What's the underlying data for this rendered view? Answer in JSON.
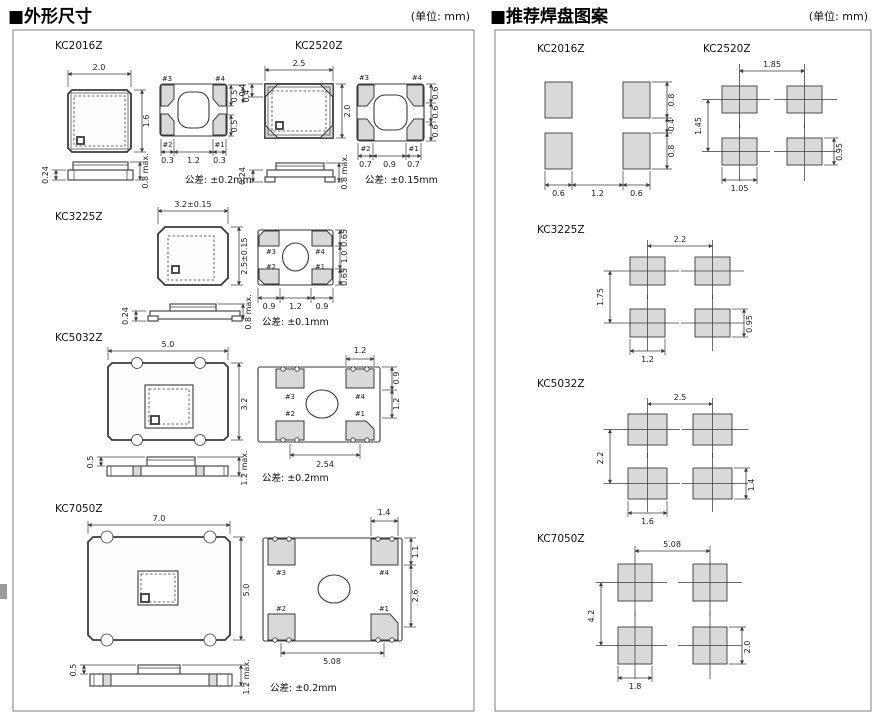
{
  "header": {
    "outline_title": "■外形尺寸",
    "land_title": "■推荐焊盘图案",
    "unit": "(单位: mm)"
  },
  "pad_labels": {
    "p1": "#1",
    "p2": "#2",
    "p3": "#3",
    "p4": "#4"
  },
  "outline": {
    "k2016": {
      "name": "KC2016Z",
      "top_w": "2.0",
      "top_h": "1.6",
      "right_dims": [
        "0.5",
        "0.4",
        "0.5"
      ],
      "bottom_dims": [
        "0.3",
        "1.2",
        "0.3"
      ],
      "side_thickness": "0.24",
      "side_height": "0.8 max.",
      "tolerance": "公差: ±0.2mm"
    },
    "k2520": {
      "name": "KC2520Z",
      "top_w": "2.5",
      "top_h": "2.0",
      "corner_pad": "0.4",
      "right_dims": [
        "0.6",
        "0.6",
        "0.6"
      ],
      "bottom_dims": [
        "0.7",
        "0.9",
        "0.7"
      ],
      "side_thickness": "0.24",
      "side_height": "0.8 max.",
      "tolerance": "公差: ±0.15mm"
    },
    "k3225": {
      "name": "KC3225Z",
      "top_w": "3.2±0.15",
      "top_h": "2.5±0.15",
      "right_dims": [
        "0.65",
        "1.0",
        "0.65"
      ],
      "bottom_dims": [
        "0.9",
        "1.2",
        "0.9"
      ],
      "side_thickness": "0.24",
      "side_height": "0.8 max.",
      "tolerance": "公差: ±0.1mm"
    },
    "k5032": {
      "name": "KC5032Z",
      "top_w": "5.0",
      "top_h": "3.2",
      "pad_w": "1.2",
      "right_dims": [
        "0.9",
        "1.2"
      ],
      "bottom_dim": "2.54",
      "side_thickness": "0.5",
      "side_height": "1.2 max.",
      "tolerance": "公差: ±0.2mm"
    },
    "k7050": {
      "name": "KC7050Z",
      "top_w": "7.0",
      "top_h": "5.0",
      "pad_w": "1.4",
      "right_dims": [
        "1.1",
        "2.6"
      ],
      "bottom_dim": "5.08",
      "side_thickness": "0.5",
      "side_height": "1.2 max.",
      "tolerance": "公差: ±0.2mm"
    }
  },
  "land": {
    "k2016": {
      "name": "KC2016Z",
      "right_dims": [
        "0.8",
        "0.4",
        "0.8"
      ],
      "bottom_dims": [
        "0.6",
        "1.2",
        "0.6"
      ]
    },
    "k2520": {
      "name": "KC2520Z",
      "pitch_x": "1.85",
      "pitch_y": "1.45",
      "pad_w": "1.05",
      "pad_h": "0.95"
    },
    "k3225": {
      "name": "KC3225Z",
      "pitch_x": "2.2",
      "pitch_y": "1.75",
      "pad_w": "1.2",
      "pad_h": "0.95"
    },
    "k5032": {
      "name": "KC5032Z",
      "pitch_x": "2.5",
      "pitch_y": "2.2",
      "pad_w": "1.6",
      "pad_h": "1.4"
    },
    "k7050": {
      "name": "KC7050Z",
      "pitch_x": "5.08",
      "pitch_y": "4.2",
      "pad_w": "1.8",
      "pad_h": "2.0"
    }
  },
  "colors": {
    "line": "#3a3a3a",
    "pad_fill": "#d9d9d9",
    "panel_border": "#7d7d7d"
  }
}
